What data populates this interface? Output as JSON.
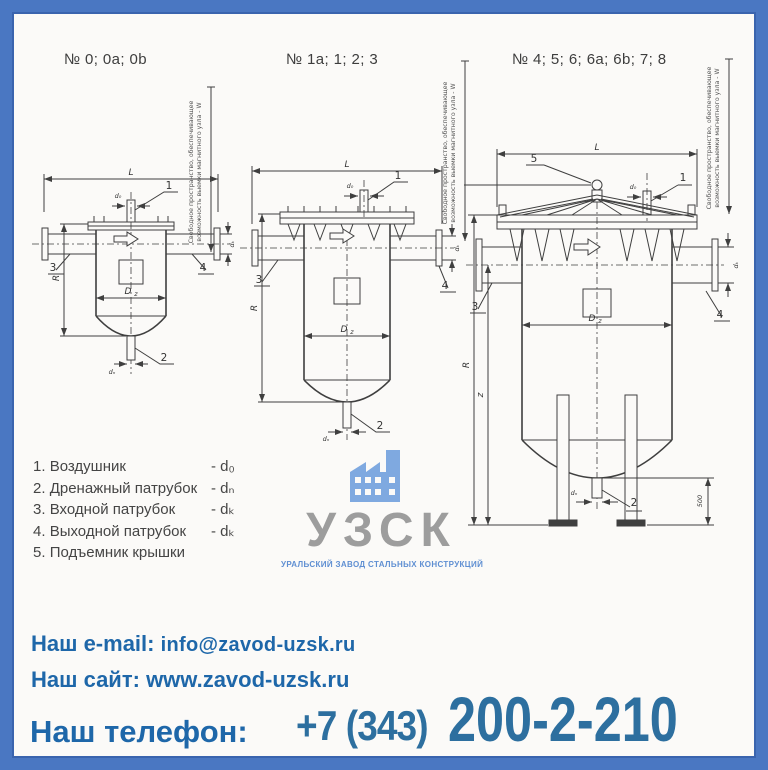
{
  "titles": {
    "d1": "№ 0; 0a; 0b",
    "d2": "№ 1a; 1; 2; 3",
    "d3": "№ 4; 5; 6; 6a; 6b; 7; 8"
  },
  "side_note": {
    "line1": "Свободное пространство, обеспечивающее",
    "line2": "возможность выемки магнитного узла - W"
  },
  "dims": {
    "L": "L",
    "R": "R",
    "z": "z",
    "D": "D",
    "z_sub": "z",
    "d0": "d₀",
    "dn": "dₙ",
    "dk": "dₖ",
    "h500": "500"
  },
  "callouts": {
    "c1": "1",
    "c2": "2",
    "c3": "3",
    "c4": "4",
    "c5": "5"
  },
  "legend": {
    "items": [
      {
        "num": "1.",
        "name": "Воздушник",
        "dim": "- d₀"
      },
      {
        "num": "2.",
        "name": "Дренажный патрубок",
        "dim": "- dₙ"
      },
      {
        "num": "3.",
        "name": "Входной патрубок",
        "dim": "- dₖ"
      },
      {
        "num": "4.",
        "name": "Выходной патрубок",
        "dim": "- dₖ"
      },
      {
        "num": "5.",
        "name": "Подъемник крышки",
        "dim": ""
      }
    ]
  },
  "logo": {
    "abbr": "УЗСК",
    "tagline": "УРАЛЬСКИЙ ЗАВОД СТАЛЬНЫХ КОНСТРУКЦИЙ",
    "icon": "factory-icon",
    "colors": {
      "icon": "#7fa9e0",
      "abbr": "#9d9d9d",
      "tagline": "#5f8fd2"
    }
  },
  "contacts": {
    "email_label": "Наш e-mail:",
    "email_value": "info@zavod-uzsk.ru",
    "site_label": "Наш сайт:",
    "site_value": "www.zavod-uzsk.ru",
    "phone_label": "Наш телефон:",
    "phone_prefix": "+7 (343)",
    "phone_number": "200-2-210",
    "accent": "#1e67a9",
    "phone_color": "#2d6f9f"
  },
  "frame": {
    "border_color": "#4a77c2",
    "inner_line_color": "#3a64ae"
  }
}
